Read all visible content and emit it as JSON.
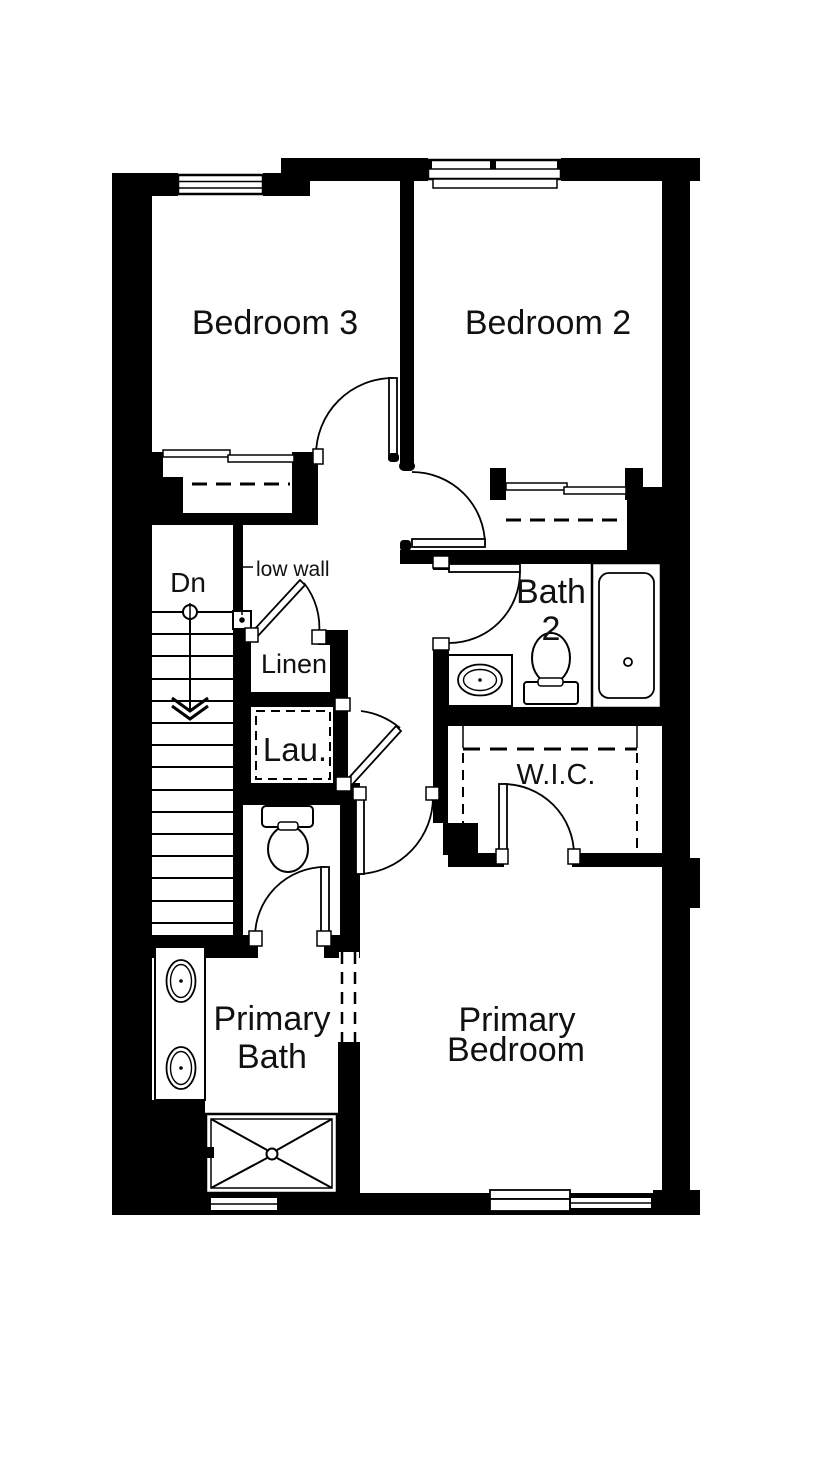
{
  "document": {
    "type": "second-floor-plan",
    "background_color": "#ffffff",
    "wall_color": "#000000",
    "text_color": "#111111"
  },
  "rooms": {
    "bedroom3": {
      "label": "Bedroom 3"
    },
    "bedroom2": {
      "label": "Bedroom 2"
    },
    "bath2": {
      "line1": "Bath",
      "line2": "2"
    },
    "linen": {
      "label": "Linen"
    },
    "laundry": {
      "label": "Lau."
    },
    "wic": {
      "label": "W.I.C."
    },
    "primary_bath": {
      "line1": "Primary",
      "line2": "Bath"
    },
    "primary_bedroom": {
      "line1": "Primary",
      "line2": "Bedroom"
    }
  },
  "annotations": {
    "stair_direction": "Dn",
    "low_wall": "low wall"
  }
}
